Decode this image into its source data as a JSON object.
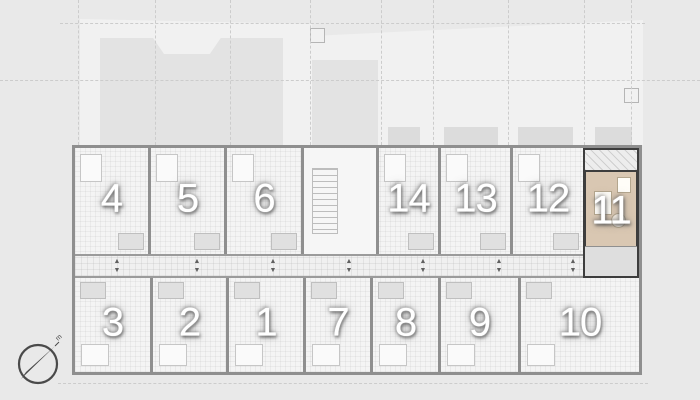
{
  "plan": {
    "highlighted_unit": "11",
    "units": [
      {
        "label": "4"
      },
      {
        "label": "5"
      },
      {
        "label": "6"
      },
      {
        "label": "14"
      },
      {
        "label": "13"
      },
      {
        "label": "12"
      },
      {
        "label": "11"
      },
      {
        "label": "3"
      },
      {
        "label": "2"
      },
      {
        "label": "1"
      },
      {
        "label": "7"
      },
      {
        "label": "8"
      },
      {
        "label": "9"
      },
      {
        "label": "10"
      }
    ]
  },
  "icons": {
    "door_swing_up": "▲",
    "door_swing_down": "▼"
  },
  "compass": {
    "label": "m"
  },
  "colors": {
    "background": "#e9e9e9",
    "site_fill": "#f1f1f1",
    "footprint_fill": "#e3e3e3",
    "floor": "#f4f4f4",
    "wall": "#8f8f8f",
    "highlight_wall": "#3d3d3d",
    "highlight_floor": "#d9c7b2",
    "unit_label": "#ffffff"
  }
}
